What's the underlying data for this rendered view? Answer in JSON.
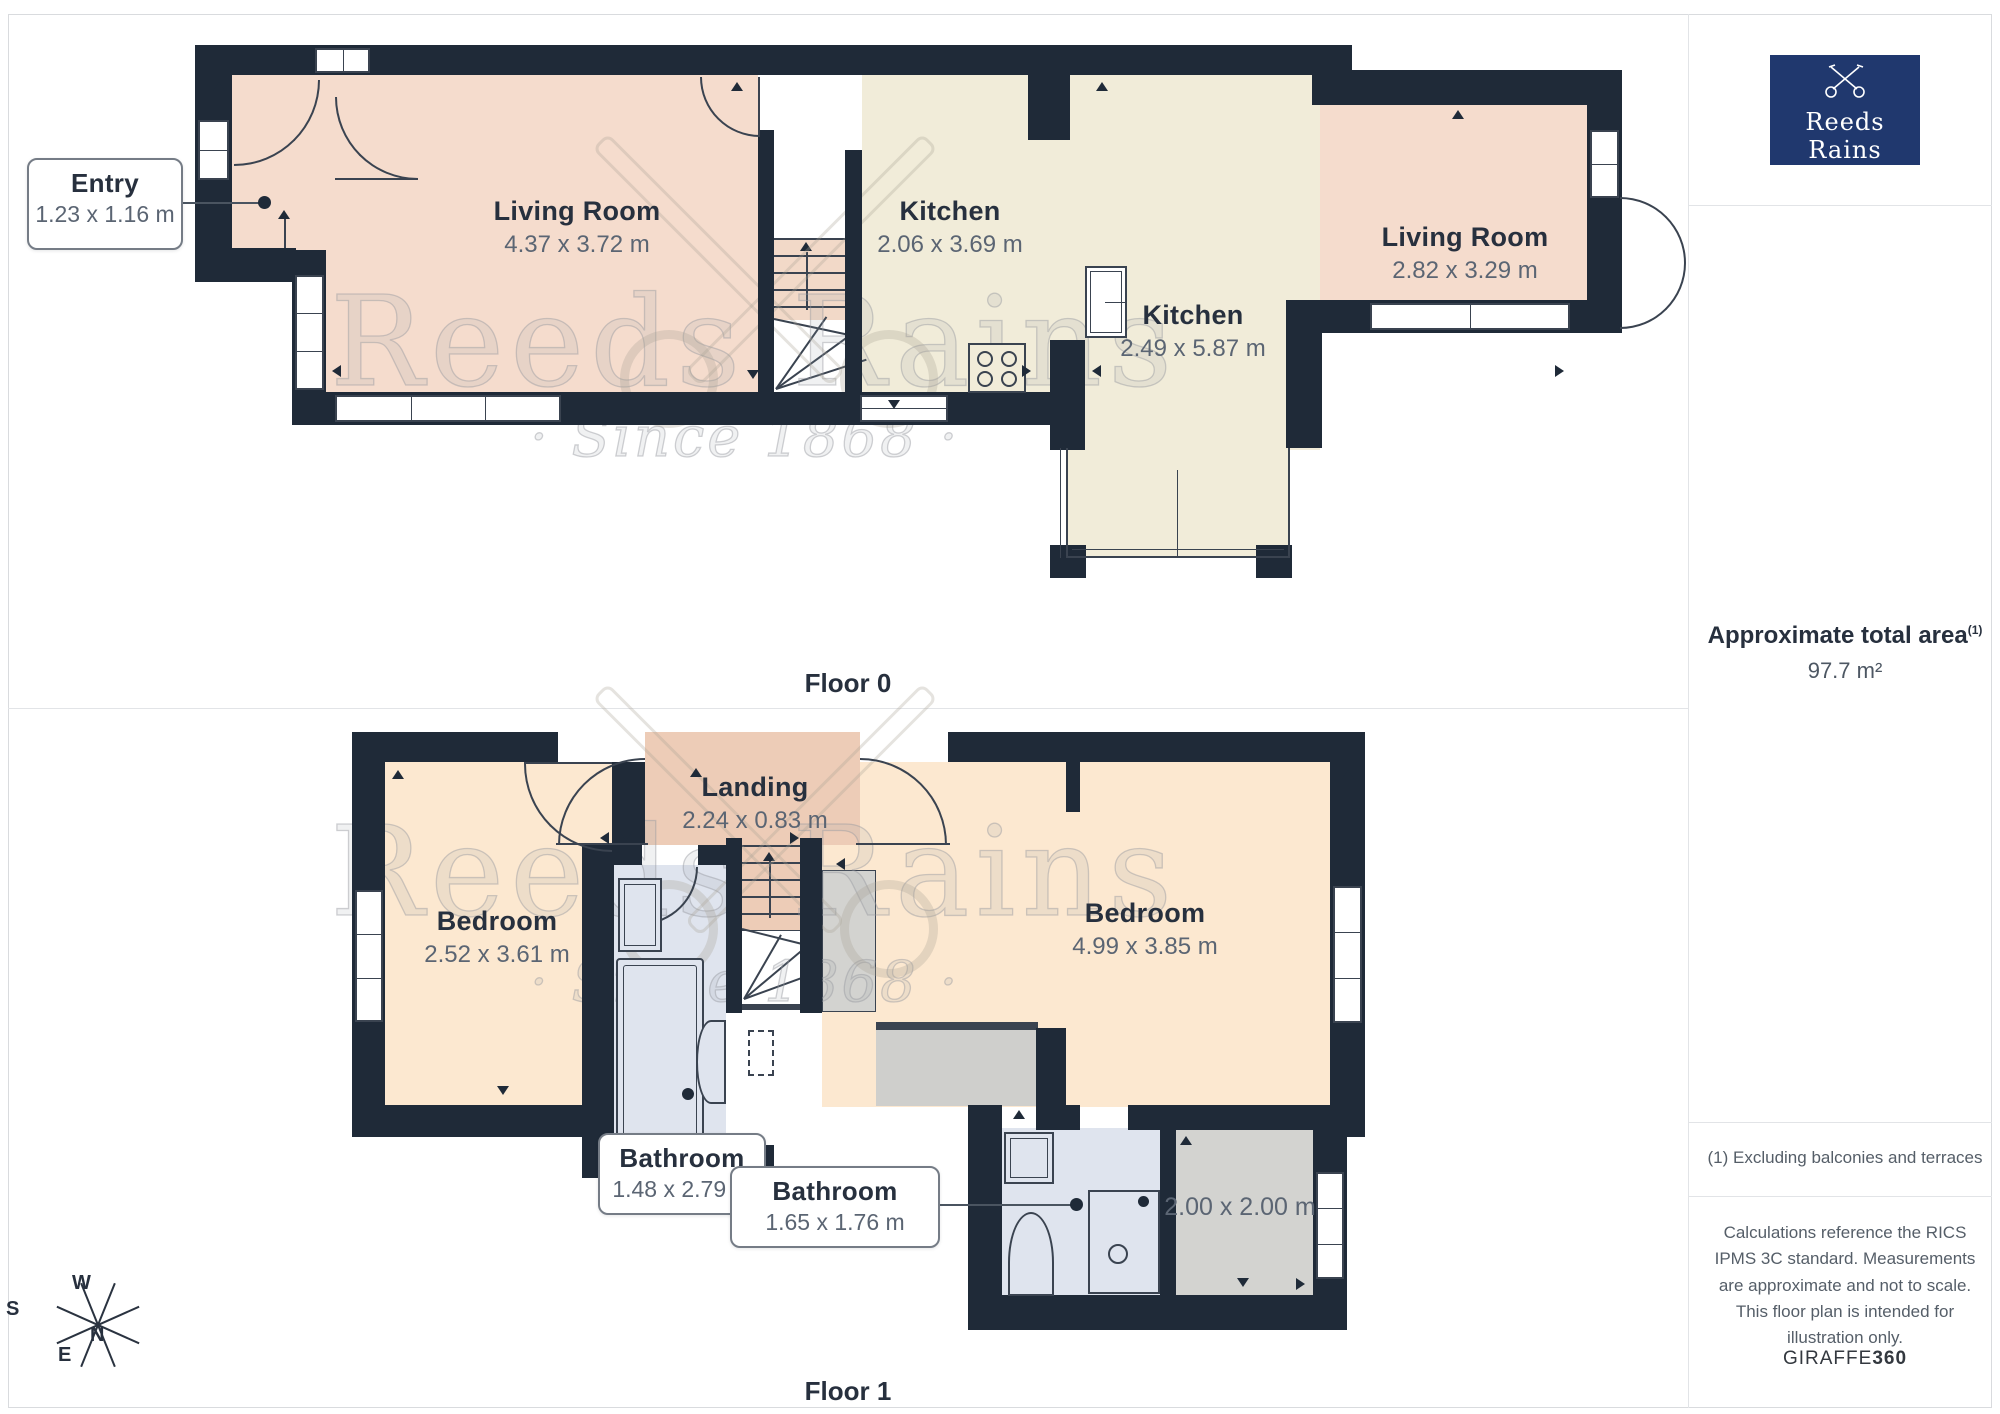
{
  "floor0": {
    "label": "Floor 0",
    "rooms": {
      "entry": {
        "name": "Entry",
        "dims": "1.23 x 1.16 m"
      },
      "living1": {
        "name": "Living Room",
        "dims": "4.37 x 3.72 m"
      },
      "kitchen1": {
        "name": "Kitchen",
        "dims": "2.06 x 3.69 m"
      },
      "kitchen2": {
        "name": "Kitchen",
        "dims": "2.49 x 5.87 m"
      },
      "living2": {
        "name": "Living Room",
        "dims": "2.82 x 3.29 m"
      }
    }
  },
  "floor1": {
    "label": "Floor 1",
    "rooms": {
      "bedroom1": {
        "name": "Bedroom",
        "dims": "2.52 x 3.61 m"
      },
      "landing": {
        "name": "Landing",
        "dims": "2.24 x 0.83 m"
      },
      "bedroom2": {
        "name": "Bedroom",
        "dims": "4.99 x 3.85 m"
      },
      "bathroom1": {
        "name": "Bathroom",
        "dims": "1.48 x 2.79 m"
      },
      "bathroom2": {
        "name": "Bathroom",
        "dims": "1.65 x 1.76 m"
      },
      "storeroom": {
        "dims": "2.00 x 2.00 m"
      }
    }
  },
  "sidebar": {
    "logo": {
      "brand": "Reeds Rains",
      "tagline": "· Since 1868 ·"
    },
    "area": {
      "label": "Approximate total area",
      "sup": "(1)",
      "value": "97.7 m²"
    },
    "note": "(1) Excluding balconies and terraces",
    "disclaimer": "Calculations reference the RICS IPMS 3C standard. Measurements are approximate and not to scale. This floor plan is intended for illustration only.",
    "credit": {
      "normal": "GIRAFFE",
      "bold": "360"
    }
  },
  "watermark": {
    "brand": "Reeds Rains",
    "tagline": "· Since 1868 ·"
  },
  "compass": {
    "n": "N",
    "s": "S",
    "e": "E",
    "w": "W"
  },
  "colors": {
    "wall": "#1f2a38",
    "living_pink": "#f5dccd",
    "landing_tan": "#edccb7",
    "kitchen_cream": "#f1ecd9",
    "bedroom_peach": "#fce8d0",
    "bathroom_blue": "#dfe4ee",
    "gray_room": "#d3d3d0",
    "logo_navy": "#20386e"
  }
}
